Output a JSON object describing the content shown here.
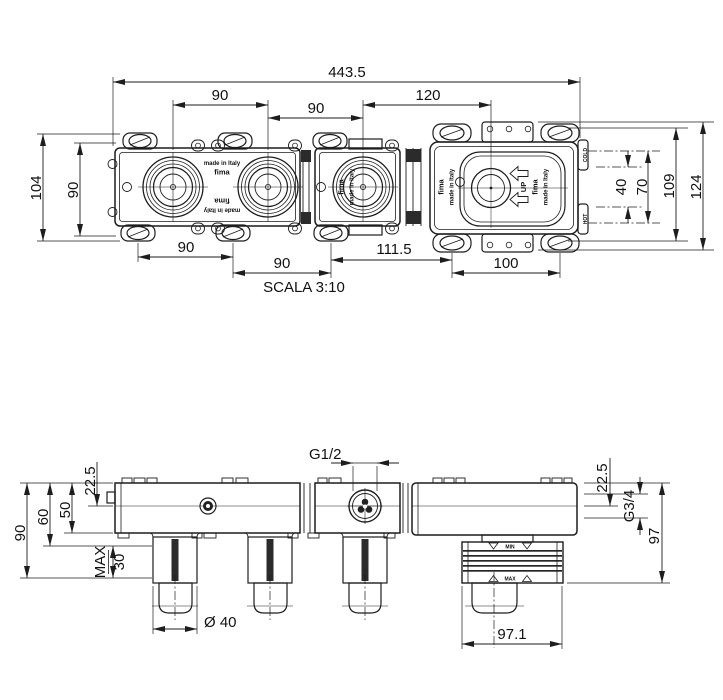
{
  "top_view": {
    "dims": {
      "overall_width": "443.5",
      "spacing_left": "90",
      "spacing_mid": "90",
      "spacing_right": "120",
      "height_overall": "104",
      "height_plate": "90",
      "bottom_span1": "90",
      "bottom_span2": "90",
      "bottom_span3": "111.5",
      "bottom_span4": "100",
      "right_40": "40",
      "right_70": "70",
      "right_109": "109",
      "right_124": "124"
    },
    "scale_label": "SCALA 3:10",
    "brand_line1": "made in Italy",
    "brand_line2": "fima",
    "up_label": "UP",
    "cold_label": "COLD",
    "hot_label": "HOT"
  },
  "bottom_view": {
    "dims": {
      "left_90": "90",
      "left_60": "60",
      "left_50": "50",
      "left_225": "22.5",
      "max_label": "MAX",
      "max_depth": "30",
      "diameter": "Ø 40",
      "flange_width": "97.1",
      "right_225": "22.5",
      "right_97": "97"
    },
    "ports": {
      "top_thread": "G1/2",
      "side_thread": "G3/4"
    },
    "markers": {
      "min": "MIN",
      "max": "MAX"
    }
  }
}
